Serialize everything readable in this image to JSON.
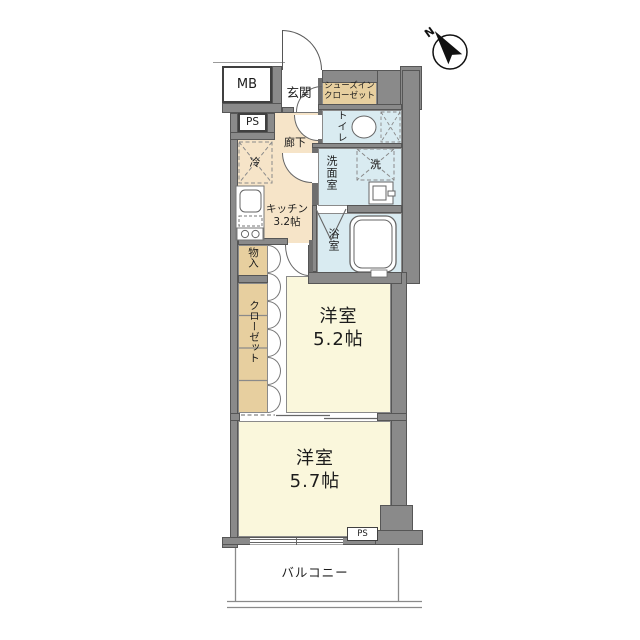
{
  "compass": {
    "north_label": "N"
  },
  "labels": {
    "mb": "MB",
    "ps_upper": "PS",
    "entrance": "玄関",
    "shoe_closet_line1": "シューズイン",
    "shoe_closet_line2": "クローゼット",
    "toilet": "トイレ",
    "hallway": "廊下",
    "refrigerator": "冷",
    "washroom": "洗面室",
    "washer": "洗",
    "kitchen_line1": "キッチン",
    "kitchen_line2": "3.2帖",
    "bathroom": "浴室",
    "storage": "物入",
    "closet": "クローゼット",
    "room_a_line1": "洋室",
    "room_a_line2": "5.2帖",
    "room_b_line1": "洋室",
    "room_b_line2": "5.7帖",
    "ps_lower": "PS",
    "balcony": "バルコニー"
  },
  "colors": {
    "wall_gray": "#8a8a8a",
    "hallway_kitchen_beige": "#f6e4c8",
    "closet_tan": "#e7cf9f",
    "wet_area_blue": "#d9ebf1",
    "room_pale_yellow": "#faf7dc",
    "outline": "#565656"
  }
}
